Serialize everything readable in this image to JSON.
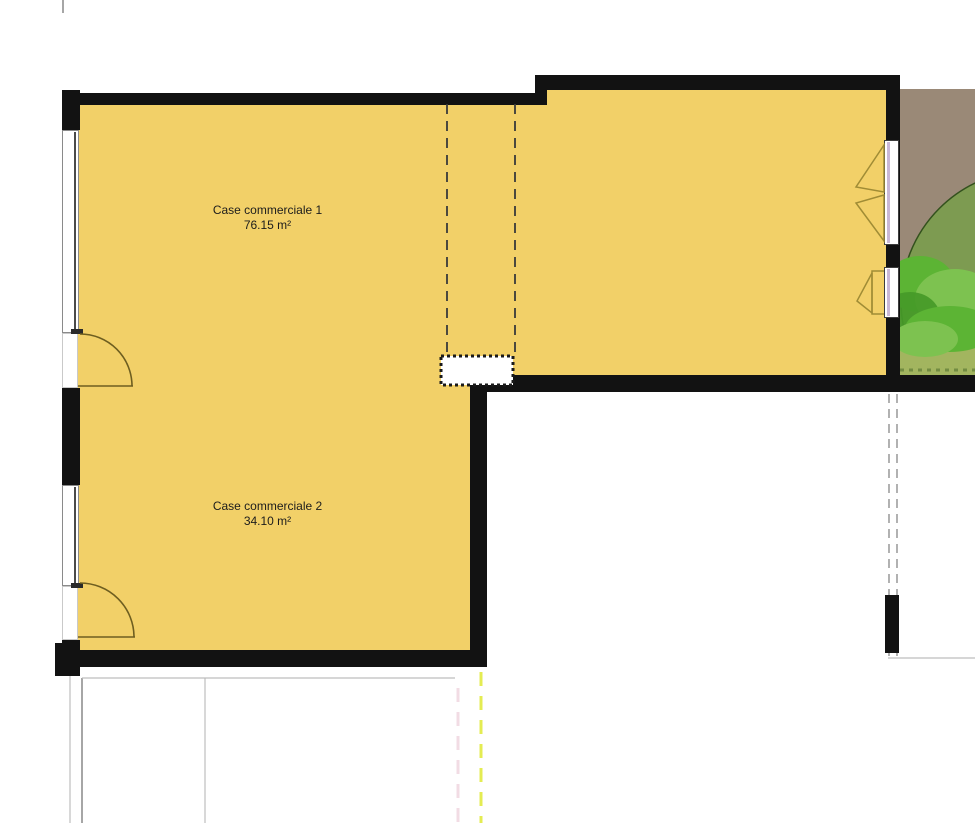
{
  "plan": {
    "rooms": [
      {
        "name": "Case commerciale 1",
        "area": "76.15 m²"
      },
      {
        "name": "Case commerciale 2",
        "area": "34.10 m²"
      }
    ]
  },
  "colors": {
    "room_fill": "#F2D068",
    "wall": "#121212",
    "garden_ground": "#9A8977",
    "tree_canopy_fill": "#7D9B51",
    "tree_canopy_stroke": "#33511D",
    "bush_light": "#7DC250",
    "bush_mid": "#5CB434",
    "bush_dark": "#459A28",
    "grass": "#A2B55F",
    "door_symbol": "#6E5E20",
    "window_triangle": "#A08C35",
    "dash_dark": "#3A3A3A",
    "dash_gray": "#9E9E9E",
    "guide_gray": "#BDBDBD",
    "boundary_yellow": "#E4EC52",
    "boundary_pink": "#F2DCE4",
    "window_glass_line": "#4A4A4A",
    "window_frame_border": "#8A8A8A",
    "window_tint": "#C9B8D6",
    "label_text": "#1C1C1C"
  }
}
